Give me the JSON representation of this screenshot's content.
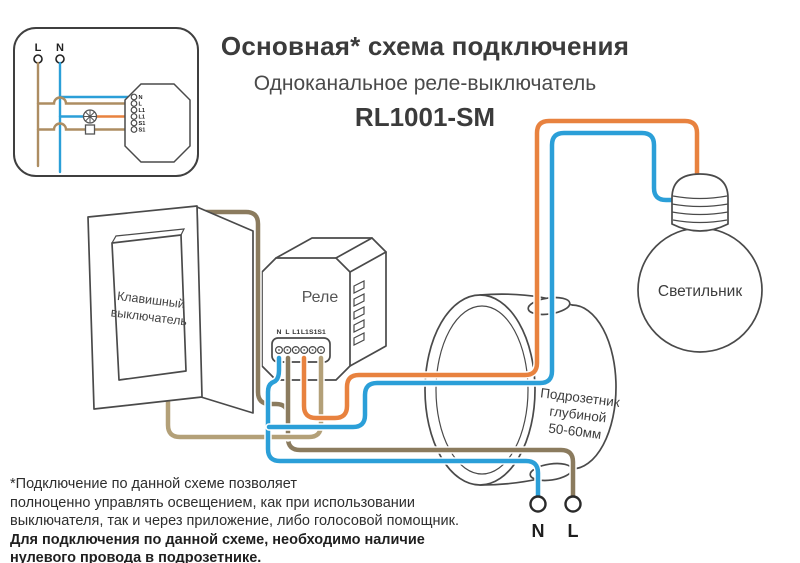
{
  "header": {
    "title": "Основная* схема подключения",
    "subtitle": "Одноканальное реле-выключатель",
    "model": "RL1001-SM"
  },
  "inset": {
    "phase_label": "L",
    "neutral_label": "N",
    "terminals": [
      "N",
      "L",
      "L1",
      "L1",
      "S1",
      "S1"
    ]
  },
  "relay": {
    "label": "Реле",
    "terminals": [
      "N",
      "L",
      "L1",
      "L1",
      "S1",
      "S1"
    ]
  },
  "wall_switch": {
    "label_line1": "Клавишный",
    "label_line2": "выключатель"
  },
  "junction_box": {
    "label_line1": "Подрозетник",
    "label_line2": "глубиной",
    "label_line3": "50-60мм"
  },
  "bulb": {
    "label": "Светильник"
  },
  "mains": {
    "neutral_label": "N",
    "phase_label": "L"
  },
  "footnote": {
    "line1": "*Подключение по данной схеме позволяет",
    "line2": "полноценно управлять освещением, как при использовании",
    "line3": "выключателя, так и через приложение, либо голосовой помощник.",
    "bold_line1": "Для подключения по данной схеме, необходимо наличие",
    "bold_line2": "нулевого провода в подрозетнике."
  },
  "colors": {
    "wire_neutral_blue": "#2b9fd8",
    "wire_load_orange": "#e8823f",
    "wire_phase_dark_brown": "#8b7b5e",
    "wire_switch_light_brown": "#b3a078",
    "outline_gray": "#4a4a4a",
    "text_dark": "#2e2e2e"
  }
}
